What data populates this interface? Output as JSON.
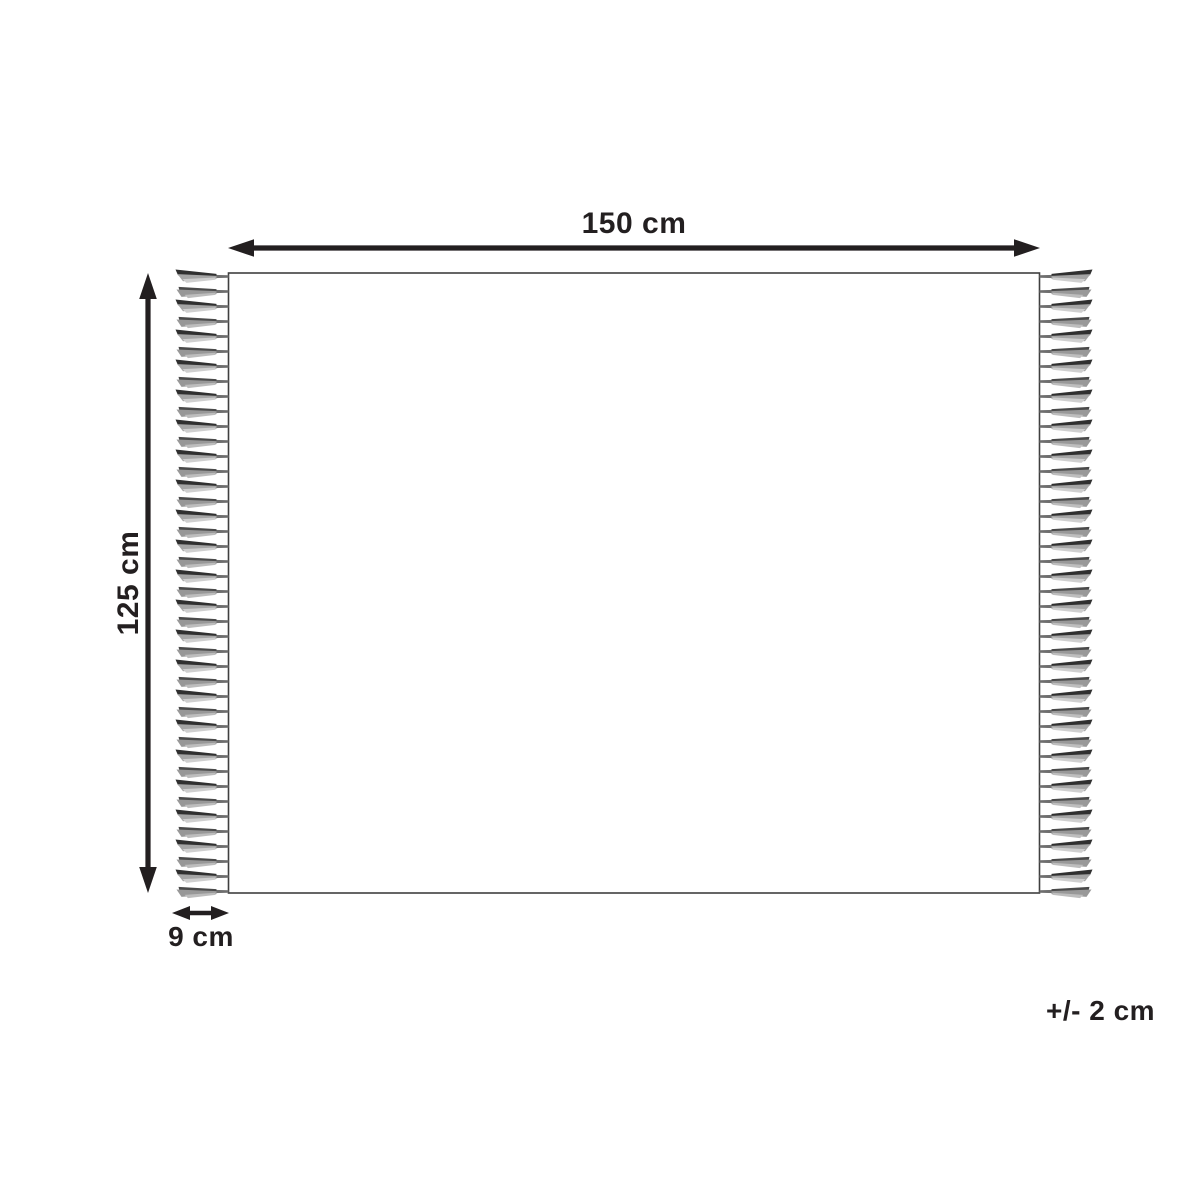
{
  "diagram": {
    "type": "product-dimension-diagram",
    "subject": "rectangular rug / throw with fringe on left and right edges"
  },
  "colors": {
    "line": "#231f20",
    "outline": "#3f3f3f",
    "fringe": "#9a9a9a",
    "background": "#ffffff"
  },
  "dimensions": {
    "width": {
      "label": "150 cm"
    },
    "height": {
      "label": "125 cm"
    },
    "fringe": {
      "label": "9 cm"
    },
    "tolerance": {
      "label": "+/- 2 cm"
    }
  },
  "fringe": {
    "sides": [
      "left",
      "right"
    ],
    "tassels_per_side": 42
  }
}
